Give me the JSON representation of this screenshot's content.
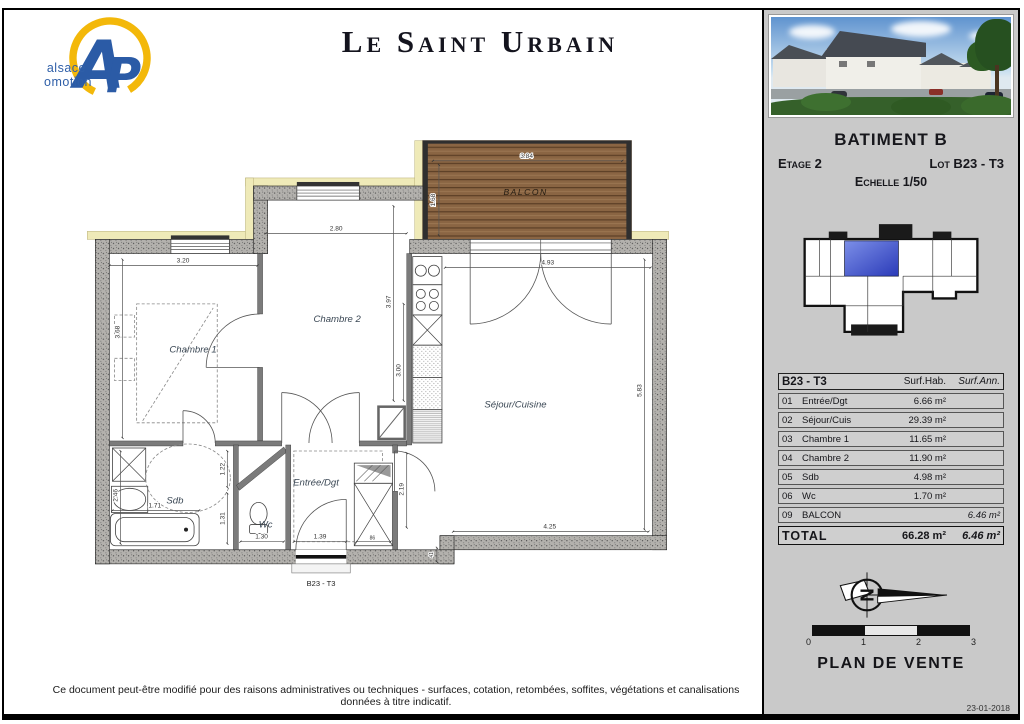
{
  "header": {
    "title": "Le Saint Urbain",
    "logo": {
      "letter_a": "A",
      "letter_p": "P",
      "line1": "alsace",
      "line2": "promotion"
    }
  },
  "sidebar": {
    "batiment": "BATIMENT B",
    "etage": "Etage 2",
    "lot": "Lot B23 - T3",
    "echelle": "Echelle 1/50",
    "table": {
      "header": {
        "lot": "B23 - T3",
        "hab": "Surf.Hab.",
        "ann": "Surf.Ann."
      },
      "rows": [
        {
          "num": "01",
          "name": "Entrée/Dgt",
          "hab": "6.66 m²",
          "ann": ""
        },
        {
          "num": "02",
          "name": "Séjour/Cuis",
          "hab": "29.39 m²",
          "ann": ""
        },
        {
          "num": "03",
          "name": "Chambre 1",
          "hab": "11.65 m²",
          "ann": ""
        },
        {
          "num": "04",
          "name": "Chambre 2",
          "hab": "11.90 m²",
          "ann": ""
        },
        {
          "num": "05",
          "name": "Sdb",
          "hab": "4.98 m²",
          "ann": ""
        },
        {
          "num": "06",
          "name": "Wc",
          "hab": "1.70 m²",
          "ann": ""
        },
        {
          "num": "09",
          "name": "BALCON",
          "hab": "",
          "ann": "6.46 m²"
        }
      ],
      "total": {
        "label": "TOTAL",
        "hab": "66.28 m²",
        "ann": "6.46 m²"
      }
    },
    "compass_letter": "N",
    "scale_labels": [
      "0",
      "1",
      "2",
      "3"
    ],
    "plan_de_vente": "PLAN DE VENTE",
    "date": "23-01-2018"
  },
  "plan": {
    "rooms": {
      "chambre1": "Chambre 1",
      "chambre2": "Chambre 2",
      "sejour": "Séjour/Cuisine",
      "sdb": "Sdb",
      "wc": "Wc",
      "entree": "Entrée/Dgt",
      "balcon": "BALCON",
      "lot_label": "B23 - T3"
    },
    "dims": {
      "c1_w": "3.20",
      "c2_w": "2.80",
      "sejour_w": "4.93",
      "balcon_w": "3.84",
      "balcon_d": "1.68",
      "c1_h": "3.68",
      "sdb_h": "2.46",
      "c2_h": "3.97",
      "kitchen_h": "3.00",
      "sejour_h": "5.83",
      "sejour_bw": "4.25",
      "nook_h": "2.19",
      "tub_w": "1.71",
      "wc_w": "1.30",
      "door_w": "1.39",
      "d122": "1.22",
      "d131": "1.31",
      "d86": "86",
      "d41": "41"
    }
  },
  "footer": {
    "disclaimer": "Ce document peut-être modifié pour des raisons administratives ou techniques - surfaces, cotation, retombées, soffites, végétations et canalisations données à titre indicatif."
  },
  "colors": {
    "key_plan_highlight": "#3c4fc0",
    "balcony_wood": "#8a6543",
    "wall_fill": "#b3b1ad",
    "facade_band": "#efeab8",
    "logo_blue": "#2b5ba6",
    "logo_yellow": "#f3b80a"
  }
}
